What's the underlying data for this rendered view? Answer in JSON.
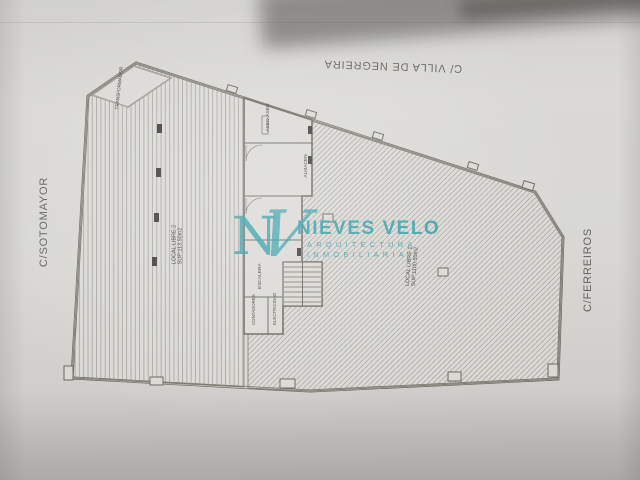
{
  "streets": {
    "top": "C/ VILLA DE NEGREIRA",
    "left": "C/SOTOMAYOR",
    "right": "C/FERREIROS"
  },
  "watermark": {
    "monogram_n": "N",
    "monogram_v": "V",
    "name": "NIEVES VELO",
    "sub1": "ARQUITECTURA",
    "sub2": "INMOBILIARIA",
    "color": "#2f9ea9"
  },
  "plan": {
    "local2_name": "LOCAL LIBRE 2",
    "local2_area": "SUP:113.50m2",
    "local1_name": "LOCAL LIBRE 1",
    "local1_area": "SUP:1100.50m2",
    "transformer_label": "TRANSFORMADOR",
    "room_labels": [
      "ASEO",
      "ASEO",
      "ALMACEN",
      "ESCALERA",
      "CONTADORES",
      "ELECTRICIDAD"
    ]
  }
}
